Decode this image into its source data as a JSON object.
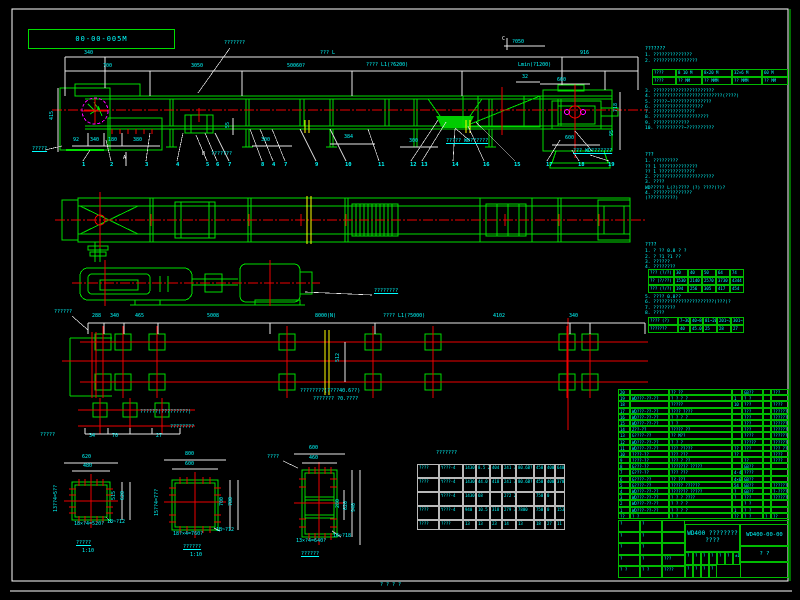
{
  "frame": {
    "corner_label": "00-00-005M",
    "bottom_mark": "? ? ? ?"
  },
  "labels": [
    {
      "t": "???????",
      "x": 224,
      "y": 41
    },
    {
      "t": "340",
      "x": 84,
      "y": 51
    },
    {
      "t": "??? L",
      "x": 320,
      "y": 51
    },
    {
      "t": "916",
      "x": 580,
      "y": 51
    },
    {
      "t": "?050",
      "x": 512,
      "y": 40
    },
    {
      "t": "C",
      "x": 502,
      "y": 37,
      "c": "w"
    },
    {
      "t": "700",
      "x": 103,
      "y": 64
    },
    {
      "t": "3050",
      "x": 191,
      "y": 64
    },
    {
      "t": "50060?",
      "x": 287,
      "y": 64
    },
    {
      "t": "???? L1(?6200)",
      "x": 366,
      "y": 63
    },
    {
      "t": "Lmin(?1200)",
      "x": 518,
      "y": 63
    },
    {
      "t": "660",
      "x": 557,
      "y": 78
    },
    {
      "t": "32",
      "x": 522,
      "y": 75
    },
    {
      "t": "415",
      "x": 50,
      "y": 120,
      "r": 1
    },
    {
      "t": "?????",
      "x": 32,
      "y": 147,
      "u": 1
    },
    {
      "t": "92",
      "x": 73,
      "y": 138
    },
    {
      "t": "340",
      "x": 90,
      "y": 138
    },
    {
      "t": "180",
      "x": 108,
      "y": 138
    },
    {
      "t": "380",
      "x": 133,
      "y": 138
    },
    {
      "t": "A",
      "x": 123,
      "y": 156,
      "c": "w"
    },
    {
      "t": "B",
      "x": 202,
      "y": 152,
      "c": "w"
    },
    {
      "t": "???????",
      "x": 211,
      "y": 152
    },
    {
      "t": "55",
      "x": 226,
      "y": 128,
      "r": 1
    },
    {
      "t": "300",
      "x": 261,
      "y": 138
    },
    {
      "t": "384",
      "x": 344,
      "y": 135
    },
    {
      "t": "300",
      "x": 409,
      "y": 139
    },
    {
      "t": "????? WD??????",
      "x": 446,
      "y": 139,
      "u": 1
    },
    {
      "t": "??? WD???????",
      "x": 573,
      "y": 149,
      "u": 1
    },
    {
      "t": "600",
      "x": 565,
      "y": 136
    },
    {
      "t": "95",
      "x": 610,
      "y": 136,
      "r": 1
    },
    {
      "t": "718",
      "x": 614,
      "y": 112,
      "r": 1
    },
    {
      "t": "????????",
      "x": 374,
      "y": 289,
      "u": 1
    },
    {
      "t": "??????",
      "x": 54,
      "y": 310
    },
    {
      "t": "288",
      "x": 92,
      "y": 314
    },
    {
      "t": "340",
      "x": 110,
      "y": 314
    },
    {
      "t": "465",
      "x": 135,
      "y": 314
    },
    {
      "t": "5008",
      "x": 207,
      "y": 314
    },
    {
      "t": "8000(N)",
      "x": 315,
      "y": 314
    },
    {
      "t": "???? L1(?5000)",
      "x": 383,
      "y": 314
    },
    {
      "t": "4102",
      "x": 493,
      "y": 314
    },
    {
      "t": "340",
      "x": 569,
      "y": 314
    },
    {
      "t": "512",
      "x": 336,
      "y": 362,
      "r": 1
    },
    {
      "t": "????????(????40.6??)",
      "x": 300,
      "y": 389
    },
    {
      "t": "??????? ?0.????",
      "x": 313,
      "y": 397
    },
    {
      "t": "??????(?????????)",
      "x": 140,
      "y": 410
    },
    {
      "t": "????????",
      "x": 170,
      "y": 425
    },
    {
      "t": "?????",
      "x": 40,
      "y": 433
    },
    {
      "t": "34",
      "x": 89,
      "y": 434
    },
    {
      "t": "70",
      "x": 112,
      "y": 434
    },
    {
      "t": "27",
      "x": 156,
      "y": 434
    },
    {
      "t": "620",
      "x": 82,
      "y": 455
    },
    {
      "t": "480",
      "x": 83,
      "y": 464
    },
    {
      "t": "515",
      "x": 112,
      "y": 500,
      "r": 1
    },
    {
      "t": "620",
      "x": 121,
      "y": 500,
      "r": 1
    },
    {
      "t": "13??4=5??",
      "x": 54,
      "y": 512,
      "r": 1
    },
    {
      "t": "18×?4=520?",
      "x": 74,
      "y": 522
    },
    {
      "t": "1B~?12",
      "x": 107,
      "y": 520
    },
    {
      "t": "?????",
      "x": 76,
      "y": 541,
      "u": 1
    },
    {
      "t": "1:10",
      "x": 82,
      "y": 549
    },
    {
      "t": "800",
      "x": 185,
      "y": 452
    },
    {
      "t": "600",
      "x": 185,
      "y": 462
    },
    {
      "t": "700",
      "x": 220,
      "y": 506,
      "r": 1
    },
    {
      "t": "780",
      "x": 229,
      "y": 506,
      "r": 1
    },
    {
      "t": "15??4=7??",
      "x": 155,
      "y": 516,
      "r": 1
    },
    {
      "t": "18?×4=760?",
      "x": 173,
      "y": 532
    },
    {
      "t": "1B~?12",
      "x": 216,
      "y": 528
    },
    {
      "t": "??????",
      "x": 183,
      "y": 545,
      "u": 1
    },
    {
      "t": "1:10",
      "x": 190,
      "y": 553
    },
    {
      "t": "????",
      "x": 267,
      "y": 455
    },
    {
      "t": "600",
      "x": 309,
      "y": 446
    },
    {
      "t": "460",
      "x": 309,
      "y": 456
    },
    {
      "t": "280",
      "x": 336,
      "y": 508,
      "r": 1
    },
    {
      "t": "620",
      "x": 344,
      "y": 510,
      "r": 1
    },
    {
      "t": "940",
      "x": 352,
      "y": 512,
      "r": 1
    },
    {
      "t": "13×?4=640?",
      "x": 296,
      "y": 539
    },
    {
      "t": "16~?18",
      "x": 333,
      "y": 534
    },
    {
      "t": "??????",
      "x": 301,
      "y": 552,
      "u": 1
    },
    {
      "t": "???????",
      "x": 436,
      "y": 451
    }
  ],
  "balloons": [
    {
      "t": "1",
      "x": 82
    },
    {
      "t": "2",
      "x": 110
    },
    {
      "t": "3",
      "x": 145
    },
    {
      "t": "4",
      "x": 176
    },
    {
      "t": "5",
      "x": 206
    },
    {
      "t": "6",
      "x": 216
    },
    {
      "t": "7",
      "x": 228
    },
    {
      "t": "8",
      "x": 261
    },
    {
      "t": "4",
      "x": 272
    },
    {
      "t": "7",
      "x": 284
    },
    {
      "t": "9",
      "x": 315
    },
    {
      "t": "10",
      "x": 345
    },
    {
      "t": "11",
      "x": 378
    },
    {
      "t": "12",
      "x": 410
    },
    {
      "t": "13",
      "x": 421
    },
    {
      "t": "14",
      "x": 452
    },
    {
      "t": "16",
      "x": 483
    },
    {
      "t": "15",
      "x": 514
    },
    {
      "t": "17",
      "x": 546
    },
    {
      "t": "18",
      "x": 578
    },
    {
      "t": "19",
      "x": 608
    }
  ],
  "notes1": {
    "title": "???????",
    "items_a": [
      "1. ??????????????",
      "2. ????????????????"
    ],
    "table": [
      [
        "????",
        "8 10 M",
        "8×20 M",
        "32×6 M",
        "60 M"
      ],
      [
        "????",
        "?? MM",
        "?? MMM",
        "?? MMM",
        "?? MM"
      ]
    ],
    "items_b": [
      "3. ??????????????????????",
      "4. ?????????????????????????(????)",
      "5. ?????~???????????????",
      "6. ??????????????????",
      "7. ???????????????",
      "8. ????????????????????",
      "9. ?????????????",
      "10. ??????????~??????????"
    ]
  },
  "notes2": {
    "title": "???",
    "lines": [
      "1. ?????????",
      "   ?? 1 ??????????????",
      "   ?? 1 ?????????????",
      "2. ??????????????????????",
      "3. ????",
      "   WD????? L(?)???? (?) ????(?)?",
      "4. ??????????????",
      "        (??????????)"
    ]
  },
  "notes3": {
    "title": "????",
    "lines_a": [
      "1. ? ?? 0.8 ? ?",
      "2. ? ?1 ?1 ??",
      "3. ??????",
      "4. ????????"
    ],
    "table_a": [
      [
        "??? (?/?)",
        "30",
        "40",
        "50",
        "64",
        "74"
      ],
      [
        "?? (?/??)",
        "1530",
        "2140",
        "2570",
        "3730",
        "4344"
      ],
      [
        "??? (?/?)",
        "194",
        "256",
        "305",
        "417",
        "454"
      ]
    ],
    "lines_b": [
      "5. ???? 0.8??",
      "6. ??????????????????????(???)?",
      "7. ????????",
      "8. ????"
    ],
    "table_b": [
      [
        "???? (?)",
        "7~30",
        "40~80",
        "81~200",
        "201~300",
        "301~400"
      ],
      [
        "???????",
        "40",
        "45.0",
        "25",
        "28",
        "27"
      ]
    ]
  },
  "motor_table": {
    "title": "???????",
    "rows": [
      [
        "????",
        "Y???-4",
        "1430",
        "8.5 24.2",
        "404",
        "241 38?",
        "80.6B?",
        "450",
        "400",
        "640"
      ],
      [
        "????",
        "Y???-4",
        "1430",
        "44.0 4.8",
        "418",
        "241 38?",
        "80.6B?",
        "450",
        "400",
        "370"
      ],
      [
        "",
        "Y???-4",
        "1430",
        "68",
        "",
        "272 234",
        "",
        "750",
        "0",
        ""
      ],
      [
        "????",
        "Y???-4",
        "940",
        "10.5 -5",
        "318",
        "279 367",
        "7800",
        "750",
        "0",
        "153"
      ],
      [
        "????",
        "????",
        "13",
        "13",
        "23",
        "14",
        "13",
        "18",
        "27",
        "11"
      ]
    ]
  },
  "bom": {
    "rows": [
      [
        "20",
        "",
        "?? ??",
        "",
        "GB??",
        "",
        "???"
      ],
      [
        "19",
        "WD???-??-??",
        "? ? ? ?",
        "1",
        "? ?",
        "",
        ""
      ],
      [
        "18",
        "",
        "?????",
        "10",
        "???",
        "",
        "????"
      ],
      [
        "17",
        "WD???-??-??",
        "???? ????",
        "",
        "???",
        "",
        "??????"
      ],
      [
        "16",
        "WD???-??-??",
        "? ? ? ?",
        "",
        "???",
        "",
        "??????"
      ],
      [
        "15",
        "WD???-??-??",
        "? ?",
        "",
        "???",
        "",
        "??????"
      ],
      [
        "14",
        "Z??-??",
        "????? ??",
        "",
        "???",
        "",
        "??????"
      ],
      [
        "13",
        "G????-??",
        "?? M??",
        "",
        "????",
        "",
        "??????"
      ],
      [
        "12",
        "WD???-??-??",
        "? ? ?",
        "",
        "?????",
        "",
        "??????"
      ],
      [
        "11",
        "WD???-??-??",
        "??? ?????",
        "??",
        "???",
        "",
        "??? ????"
      ],
      [
        "10",
        "????-??",
        "??? ???",
        "??",
        "",
        "",
        "????"
      ],
      [
        "9",
        "????-??",
        "??? ? ??",
        "",
        "??",
        "",
        "????"
      ],
      [
        "8",
        "G???-??",
        "??????? ?????",
        "",
        "GB??",
        "",
        ""
      ],
      [
        "7",
        "G???-??",
        "??? ???",
        "4-4",
        "????",
        "",
        ""
      ],
      [
        "6",
        "G????-??",
        "?? ???",
        "4×6",
        "GB??",
        "",
        ""
      ],
      [
        "5",
        "G????-??",
        "????? ??????",
        "54",
        "GB??",
        "",
        "??????"
      ],
      [
        "4",
        "WD???-??-??",
        "??????? ?????",
        "?",
        "GB??",
        "",
        "?-??????"
      ],
      [
        "3",
        "WD???-??-??",
        "? ? ? ????",
        "?",
        "???",
        "",
        "??????"
      ],
      [
        "2",
        "WD???-??-??",
        "? ? ? ?",
        "",
        "? ?",
        "",
        ""
      ],
      [
        "1",
        "WD???-??-??",
        "? ? ? ?",
        "1",
        "? ?",
        "",
        ""
      ],
      [
        "??",
        "? ?",
        "? ?",
        "??",
        "? ?",
        "?",
        "??"
      ]
    ]
  },
  "title_block": {
    "title_line1": "WD400 ????????",
    "title_line2": "????",
    "drawing_no": "WD400-00-00",
    "approve": "? ?",
    "rev_rows": [
      [
        "?",
        "?",
        ""
      ],
      [
        "?",
        "?",
        ""
      ],
      [
        "?",
        "?",
        ""
      ],
      [
        "?",
        "?",
        "???"
      ],
      [
        "? ?",
        "? ?",
        "????"
      ]
    ],
    "mid_cells": [
      [
        "?",
        "?",
        "?",
        "?",
        "?",
        "?",
        "±13"
      ],
      [
        "?",
        "?",
        "?",
        "?"
      ]
    ]
  }
}
